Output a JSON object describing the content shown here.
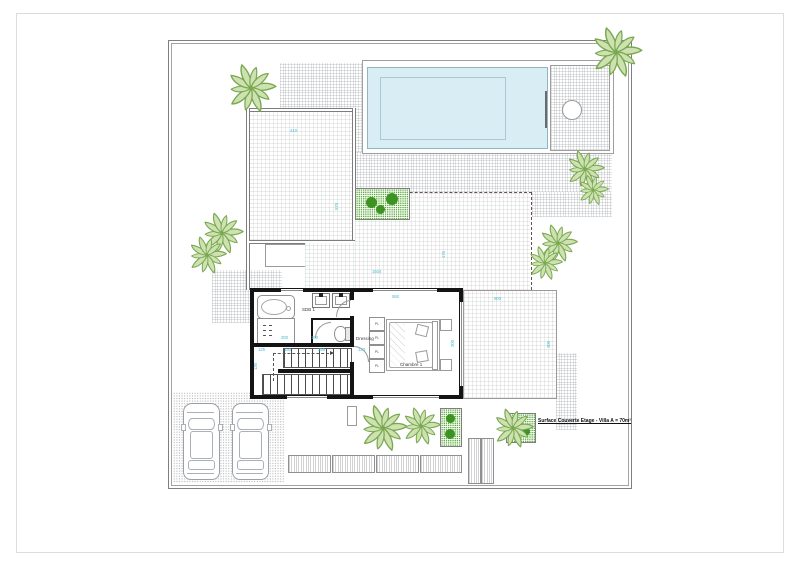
{
  "labels": {
    "area_note": "Surface Couverte Etage - Villa A = 70m²",
    "bathroom": "SDB 1",
    "dressing": "Dressing",
    "bedroom": "Chambre 1",
    "wardrobe": "PL"
  },
  "dimensions": {
    "terrace_width": "410",
    "terrace_height": "570",
    "patio_width": "1504",
    "patio_height": "175",
    "east_terrace_width": "500",
    "east_terrace_height": "300",
    "bedroom_width": "592",
    "bedroom_height": "300",
    "bath_width": "300",
    "wc_width": "190",
    "stair_run_1": "125",
    "stair_run_2": "150",
    "stair_run_3": "256",
    "hall_width": "120",
    "stair_height": "130"
  },
  "colors": {
    "pool_water": "#d9edf5",
    "palm_green": "#7aa851",
    "planter_green": "#2e8b12",
    "dimension_text": "#4ec0d6",
    "wall": "#141414"
  }
}
